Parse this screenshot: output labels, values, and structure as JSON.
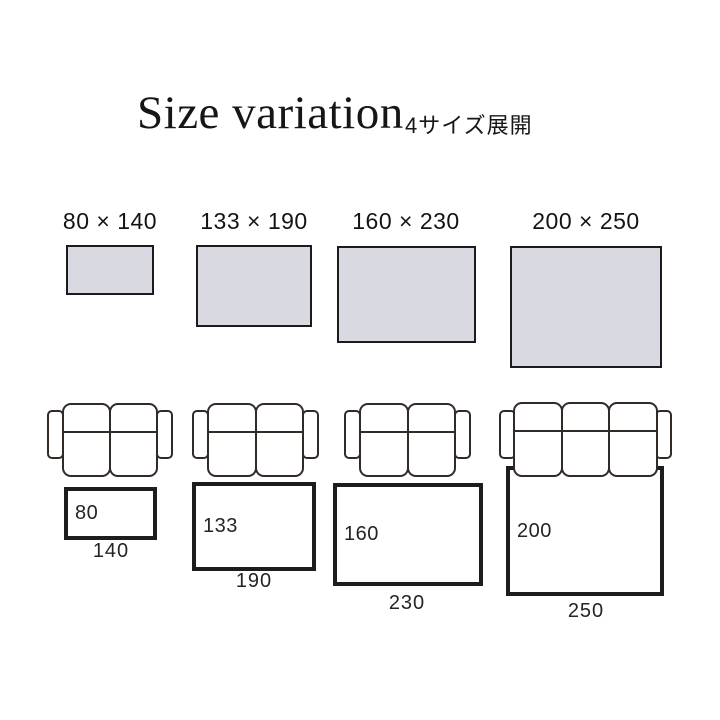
{
  "header": {
    "title": "Size variation",
    "subtitle": "4サイズ展開"
  },
  "colors": {
    "swatch_fill": "#d8d9e1",
    "swatch_border": "#1b1b1b",
    "rug_border": "#1d1d1d",
    "sofa_line": "#322a26",
    "background": "#ffffff"
  },
  "sizes": [
    {
      "id": "80x140",
      "label": "80 × 140",
      "depth": "80",
      "width": "140",
      "seats": 2
    },
    {
      "id": "133x190",
      "label": "133 × 190",
      "depth": "133",
      "width": "190",
      "seats": 2
    },
    {
      "id": "160x230",
      "label": "160 × 230",
      "depth": "160",
      "width": "230",
      "seats": 2
    },
    {
      "id": "200x250",
      "label": "200 × 250",
      "depth": "200",
      "width": "250",
      "seats": 3
    }
  ]
}
